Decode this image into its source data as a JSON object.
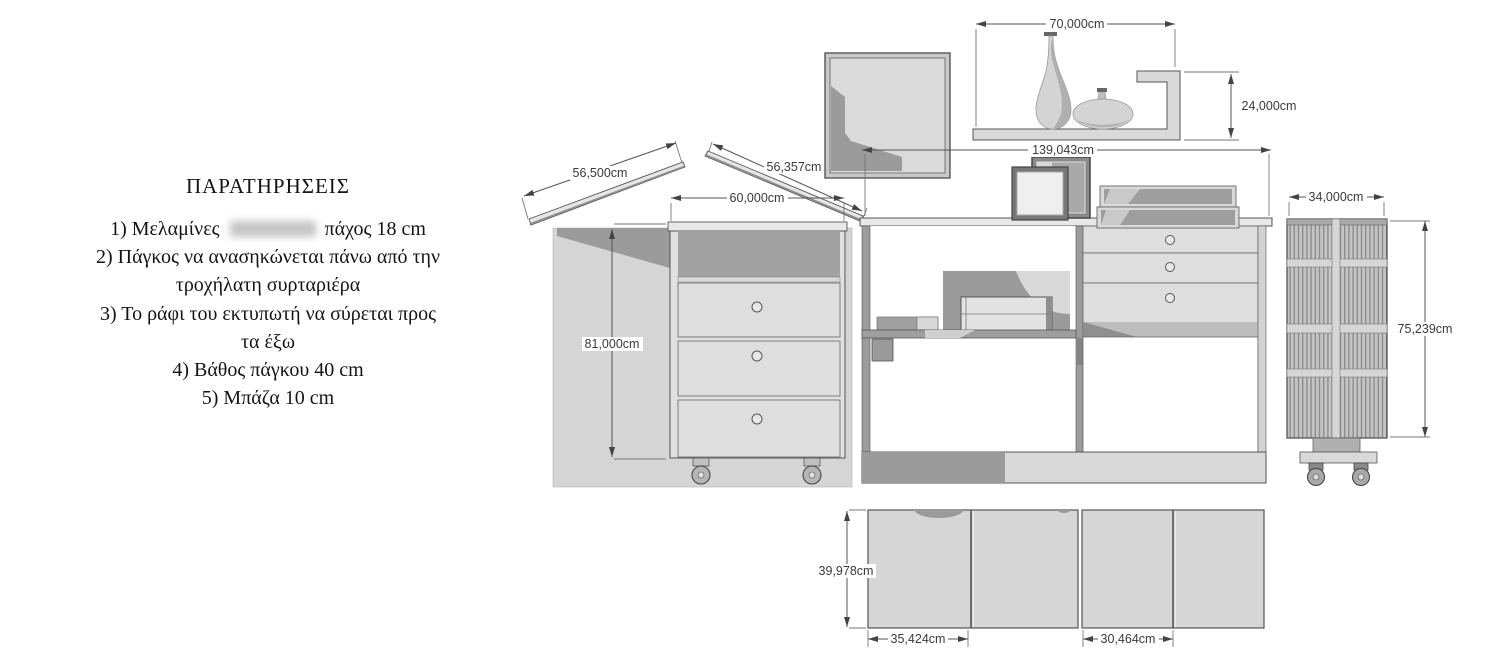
{
  "title": "Furniture construction drawing (desk, drawer units, shelf)",
  "notes": {
    "title": "ΠΑΡΑΤΗΡΗΣΕΙΣ",
    "line1_pre": "1) Μελαμίνες",
    "line1_redacted": "blurred brand name",
    "line1_post": "πάχος 18 cm",
    "line2": "2) Πάγκος να ανασηκώνεται πάνω από την",
    "line3": "τροχήλατη συρταριέρα",
    "line4": "3) Το ράφι του εκτυπωτή να σύρεται προς",
    "line5": "τα έξω",
    "line6": "4) Βάθος πάγκου 40 cm",
    "line7": "5) Μπάζα 10 cm"
  },
  "dimensions": {
    "plank_left": "56,500cm",
    "plank_right": "56,357cm",
    "drawer_unit_width": "60,000cm",
    "drawer_unit_height": "81,000cm",
    "desk_width": "139,043cm",
    "wall_shelf_width": "70,000cm",
    "wall_shelf_height": "24,000cm",
    "rack_width": "34,000cm",
    "rack_height": "75,239cm",
    "panel_height": "39,978cm",
    "panel_a_width": "35,424cm",
    "panel_b_width": "30,464cm"
  },
  "colors": {
    "background": "#ffffff",
    "outline": "#555555",
    "fill_light": "#d9d9d9",
    "fill_mid": "#a8a8a8",
    "fill_dark": "#8f8f8f",
    "dim_text": "#3a3a3a"
  }
}
